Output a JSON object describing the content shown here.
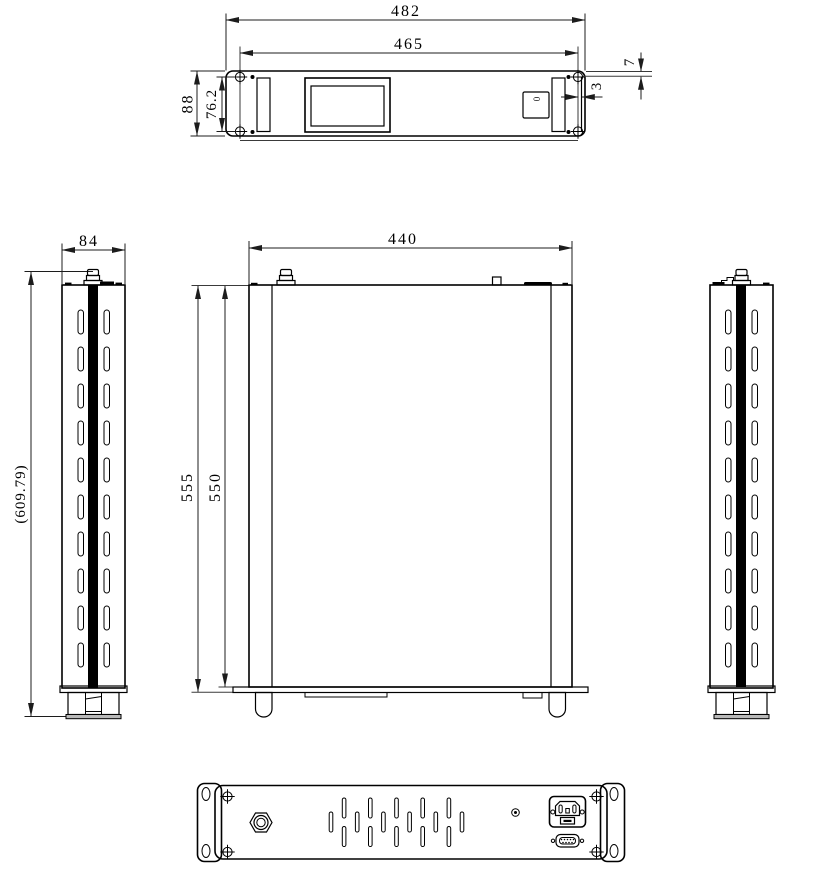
{
  "drawing": {
    "views": {
      "front": {
        "overall_width": "482",
        "mount_width": "465",
        "overall_height": "88",
        "mount_height": "76.2",
        "top_gap": "7",
        "side_gap": "3",
        "switch_label": "0"
      },
      "side_left": {
        "width": "84",
        "overall_height": "(609.79)"
      },
      "center": {
        "depth": "440",
        "height_outer": "555",
        "height_inner": "550"
      }
    }
  }
}
